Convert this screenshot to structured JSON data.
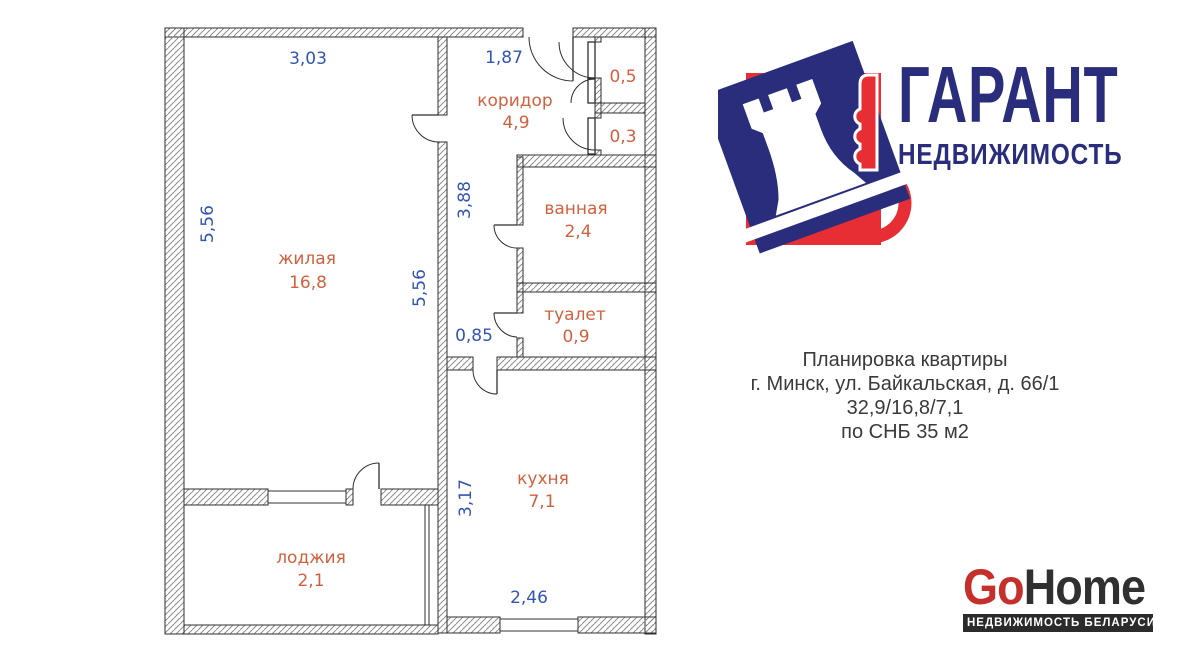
{
  "floor_plan": {
    "rooms": {
      "living": {
        "label": "жилая",
        "area": "16,8"
      },
      "corridor": {
        "label": "коридор",
        "area": "4,9"
      },
      "bath": {
        "label": "ванная",
        "area": "2,4"
      },
      "wc": {
        "label": "туалет",
        "area": "0,9"
      },
      "kitchen": {
        "label": "кухня",
        "area": "7,1"
      },
      "loggia": {
        "label": "лоджия",
        "area": "2,1"
      },
      "closet_top": {
        "area": "0,5"
      },
      "closet_bottom": {
        "area": "0,3"
      }
    },
    "dimensions": {
      "living_top": "3,03",
      "corridor_top": "1,87",
      "living_left": "5,56",
      "living_right": "5,56",
      "corridor_height": "3,88",
      "corridor_bottom": "0,85",
      "kitchen_left": "3,17",
      "kitchen_bottom": "2,46"
    },
    "colors": {
      "dimension_blue": "#3454b4",
      "room_orange": "#d2603e",
      "wall": "#2f2f2f"
    }
  },
  "garant_logo": {
    "title": "ГАРАНТ",
    "subtitle": "НЕДВИЖИМОСТЬ",
    "navy": "#2a2d7c",
    "red": "#e62e34"
  },
  "listing_info": {
    "line1": "Планировка квартиры",
    "line2": "г. Минск, ул. Байкальская, д. 66/1",
    "line3": "32,9/16,8/7,1",
    "line4": "по СНБ 35 м2"
  },
  "gohome_logo": {
    "go": "Go",
    "home": "Home",
    "tagline": "НЕДВИЖИМОСТЬ БЕЛАРУСИ",
    "red": "#c5302d",
    "dark": "#2b2b2b"
  }
}
